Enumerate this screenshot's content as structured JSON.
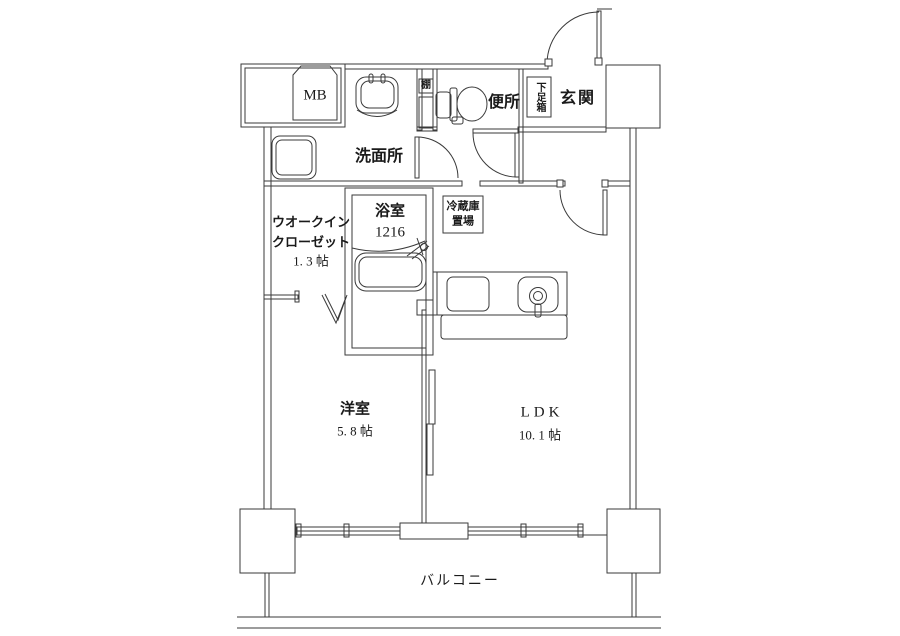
{
  "plan_title": "apartment-floor-plan-1ldk",
  "line_color": "#3a3a3a",
  "text_color": "#1a1a1a",
  "rooms": {
    "meter_box": {
      "label": "MB"
    },
    "washroom": {
      "label": "洗面所"
    },
    "shelf": {
      "label": "棚"
    },
    "toilet": {
      "label": "便所"
    },
    "shoe_box": {
      "label": "下足箱"
    },
    "entrance": {
      "label": "玄関"
    },
    "walk_in_closet": {
      "label_line1": "ウオークイン",
      "label_line2": "クローゼット",
      "area": "1. 3 帖"
    },
    "bathroom": {
      "label": "浴室",
      "size": "1216"
    },
    "fridge_space": {
      "label_line1": "冷蔵庫",
      "label_line2": "置場"
    },
    "western_room": {
      "label": "洋室",
      "area": "5. 8 帖"
    },
    "ldk": {
      "label": "LDK",
      "area": "10. 1 帖"
    },
    "balcony": {
      "label": "バルコニー"
    }
  }
}
